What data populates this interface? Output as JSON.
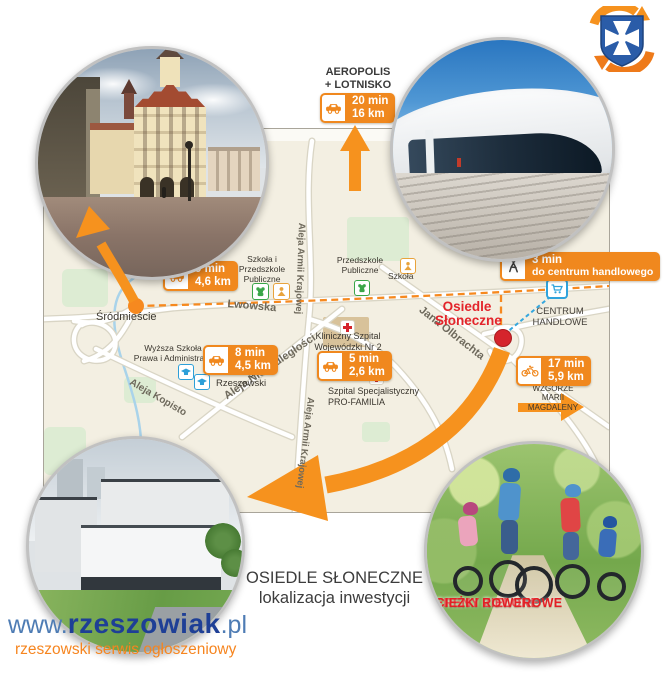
{
  "colors": {
    "accent_orange": "#F0881E",
    "arrow_orange": "#F6921E",
    "map_background": "#F3EFE2",
    "brand_red": "#E3242B",
    "info_blue": "#2FA3DC",
    "crest_blue": "#2A5CA8",
    "link_blue": "#4E7CB4",
    "brand_navy": "#1E3F96",
    "tagline_orange": "#F6851F"
  },
  "icons": {
    "crest": "rzeszow-crest",
    "car": "car-icon",
    "pedestrian": "pedestrian-icon",
    "bicycle": "bicycle-icon",
    "cart": "shopping-cart-icon",
    "red_cross": "red-cross-icon",
    "kindergarten": "kindergarten-icon",
    "school": "school-icon",
    "university": "graduation-cap-icon"
  },
  "airport_poi": {
    "line1": "AEROPOLIS",
    "line2": "+ LOTNISKO"
  },
  "badges": {
    "airport": {
      "line1": "20 min",
      "line2": "16 km"
    },
    "srodmiescie": {
      "line1": "9 min",
      "line2": "4,6 km"
    },
    "university": {
      "line1": "8 min",
      "line2": "4,5 km"
    },
    "hospital": {
      "line1": "5 min",
      "line2": "2,6 km"
    },
    "mall": {
      "line1": "3 min",
      "line2": "do centrum handlowego"
    },
    "hill": {
      "line1": "17 min",
      "line2": "5,9 km"
    }
  },
  "map": {
    "streets": {
      "lwowska": "Lwowska",
      "armii_krajowej": "Aleja Armii Krajowej",
      "niepodleglosci": "Aleja Niepodległości",
      "kopisto": "Aleja Kopisto",
      "olbrachta": "Jana Olbrachta"
    },
    "places": {
      "srodmiescie": "Śródmieście",
      "szkola_przedszkole_l1": "Szkoła i",
      "szkola_przedszkole_l2": "Przedszkole",
      "szkola_przedszkole_l3": "Publiczne",
      "przedszkole_l1": "Przedszkole",
      "przedszkole_l2": "Publiczne",
      "szkola": "Szkoła",
      "wyzsza_l1": "Wyższa Szkoła",
      "wyzsza_l2": "Prawa i Administracji",
      "uniwersytet_l1": "Uniwersytet",
      "uniwersytet_l2": "Rzeszowski",
      "szpital_kliniczny_l1": "Kliniczny Szpital",
      "szpital_kliniczny_l2": "Wojewódzki Nr 2",
      "szpital_pro_l1": "Szpital Specjalistyczny",
      "szpital_pro_l2": "PRO-FAMILIA",
      "osiedle_l1": "Osiedle",
      "osiedle_l2": "Słoneczne",
      "centrum_l1": "CENTRUM",
      "centrum_l2": "HANDLOWE",
      "wzgorze_l1": "WZGÓRZE",
      "wzgorze_l2": "MARII MAGDALENY"
    }
  },
  "photo_captions": {
    "greenery_line1": "TERENY ZIELONE",
    "greenery_line2": "ŚCIEŻKI ROWEROWE"
  },
  "footer": {
    "title_line1": "OSIEDLE SŁONECZNE",
    "title_line2": "lokalizacja inwestycji"
  },
  "site": {
    "prefix": "www.",
    "name": "rzeszowiak",
    "tld": ".pl",
    "tagline": "rzeszowski serwis ogłoszeniowy"
  }
}
